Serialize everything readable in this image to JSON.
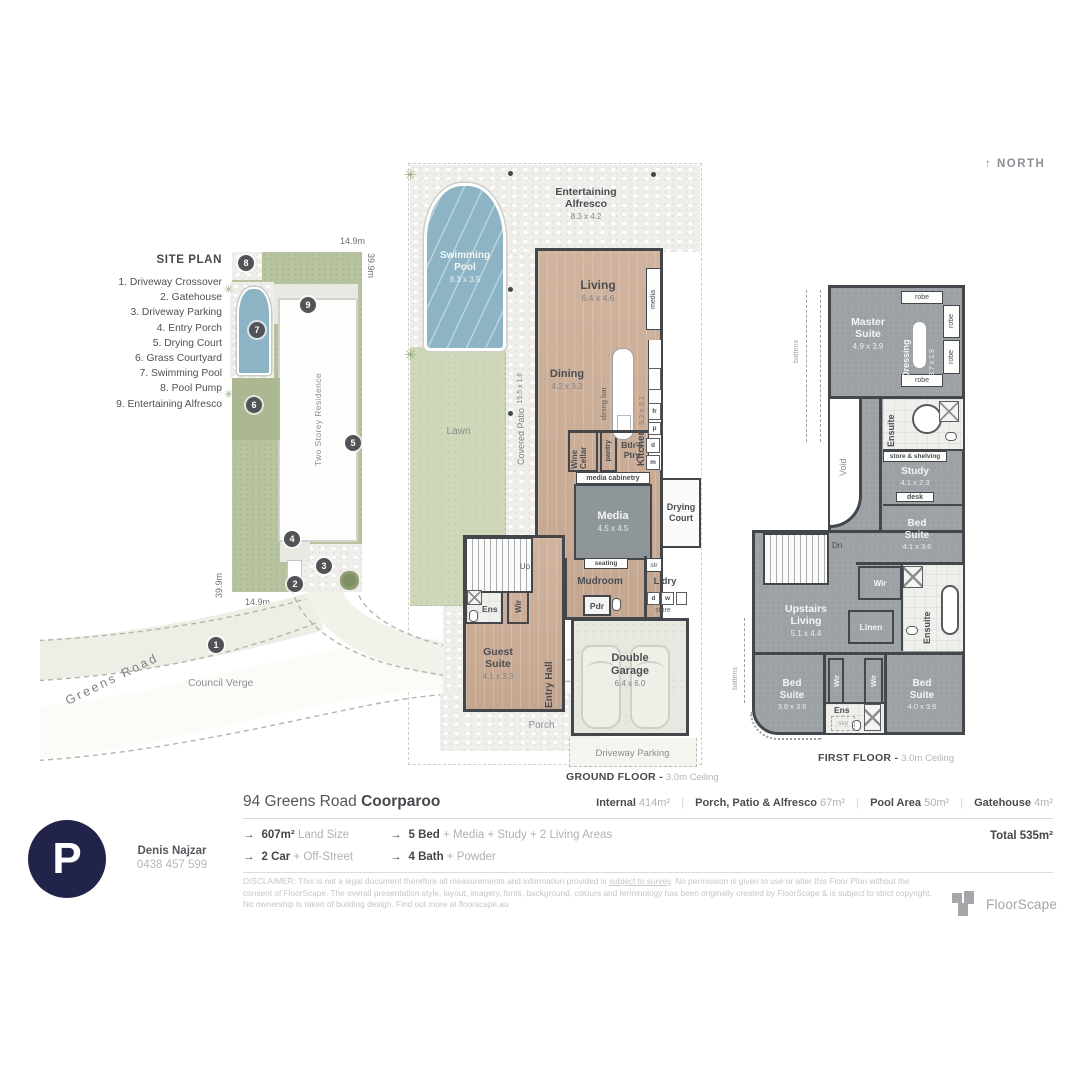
{
  "north": "↑ NORTH",
  "site_plan": {
    "title": "SITE PLAN",
    "legend": [
      "1. Driveway Crossover",
      "2. Gatehouse",
      "3. Driveway Parking",
      "4. Entry Porch",
      "5. Drying Court",
      "6. Grass Courtyard",
      "7. Swimming Pool",
      "8. Pool Pump",
      "9. Entertaining Alfresco"
    ],
    "markers": [
      "1",
      "2",
      "3",
      "4",
      "5",
      "6",
      "7",
      "8",
      "9"
    ],
    "residence_label": "Two Storey Residence",
    "council_verge": "Council Verge",
    "road_name": "Greens Road",
    "dim_top": "14.9m",
    "dim_right": "39.9m",
    "dim_left": "39.9m",
    "dim_bottom": "14.9m"
  },
  "ground_floor": {
    "caption": "GROUND FLOOR -",
    "ceiling": "3.0m Ceiling",
    "alfresco_label": "Entertaining Alfresco",
    "alfresco_dims": "8.3 x 4.2",
    "pool_label": "Swimming Pool",
    "pool_dims": "8.3 x 3.5",
    "lawn": "Lawn",
    "covered_patio": "Covered Patio",
    "covered_patio_dims": "15.5 x 1.6",
    "living": "Living",
    "living_dims": "6.4 x 4.6",
    "dining": "Dining",
    "dining_dims": "4.2 x 3.3",
    "kitchen": "Kitchen",
    "kitchen_dims": "5.2 x 3.1",
    "dining_bar": "dining bar",
    "media_wall": "media",
    "fr": "fr",
    "p": "p",
    "wine": "Wine",
    "cellar": "Cellar",
    "pantry": "pantry",
    "btlrs_1": "Btlr's",
    "btlrs_2": "Ptry",
    "d": "d",
    "m": "m",
    "media_cabinetry": "media cabinetry",
    "media_room": "Media",
    "media_dims": "4.5 x 4.5",
    "drying_1": "Drying",
    "drying_2": "Court",
    "seating": "seating",
    "mudroom": "Mudroom",
    "str": "str",
    "ldry": "L'dry",
    "dw_d": "d",
    "dw_w": "w",
    "store": "store",
    "pdr": "Pdr",
    "ens": "Ens",
    "wir": "Wir",
    "up": "Up",
    "guest_1": "Guest",
    "guest_2": "Suite",
    "guest_dims": "4.1 x 3.3",
    "entry_hall": "Entry Hall",
    "garage_1": "Double",
    "garage_2": "Garage",
    "garage_dims": "6.4 x 6.0",
    "porch": "Porch",
    "driveway_parking": "Driveway Parking"
  },
  "first_floor": {
    "caption": "FIRST FLOOR -",
    "ceiling": "3.0m Ceiling",
    "master_1": "Master",
    "master_2": "Suite",
    "master_dims": "4.9 x 3.9",
    "dressing": "Dressing",
    "dressing_dims": "3.7 x 1.9",
    "robe": "robe",
    "ensuite": "Ensuite",
    "store_shelving": "store & shelving",
    "study": "Study",
    "study_dims": "4.1 x 2.3",
    "desk": "desk",
    "bed_1": "Bed",
    "bed_2": "Suite",
    "bed_mid_dims": "4.1 x 3.6",
    "dn": "Dn",
    "void": "Void",
    "battens": "battens",
    "wir": "Wir",
    "linen": "Linen",
    "upstairs_1": "Upstairs",
    "upstairs_2": "Living",
    "upstairs_dims": "5.1 x 4.4",
    "bed_left_dims": "3.8 x 3.6",
    "bed_right_dims": "4.0 x 3.6",
    "ens": "Ens",
    "sky": "sky"
  },
  "footer": {
    "address_main": "94 Greens Road",
    "address_suburb": "Coorparoo",
    "pipe": "|",
    "areas": [
      {
        "label": "Internal",
        "value": "414m²"
      },
      {
        "label": "Porch, Patio & Alfresco",
        "value": "67m²"
      },
      {
        "label": "Pool Area",
        "value": "50m²"
      },
      {
        "label": "Gatehouse",
        "value": "4m²"
      }
    ],
    "arrow": "→",
    "features": [
      {
        "bold": "607m²",
        "rest": "Land Size"
      },
      {
        "bold": "5 Bed",
        "rest": "+ Media + Study + 2 Living Areas"
      },
      {
        "bold": "2 Car",
        "rest": "+ Off-Street"
      },
      {
        "bold": "4 Bath",
        "rest": "+ Powder"
      }
    ],
    "total": "Total 535m²",
    "disclaimer_pre": "DISCLAIMER: This is not a legal document therefore all measurements and information provided is ",
    "disclaimer_underline": "subject to survey",
    "disclaimer_post": ". No permission is given to use or alter this Floor Plan without the consent of FloorScape. The overall presentation style, layout, imagery, fonts, background, colours and terminology has been originally created by FloorScape & is subject to strict copyright. No ownership is taken of building design. Find out more at floorscape.au",
    "brand": "FloorScape",
    "logo_letter": "P",
    "agent_name": "Denis Najzar",
    "agent_phone": "0438 457 599"
  }
}
